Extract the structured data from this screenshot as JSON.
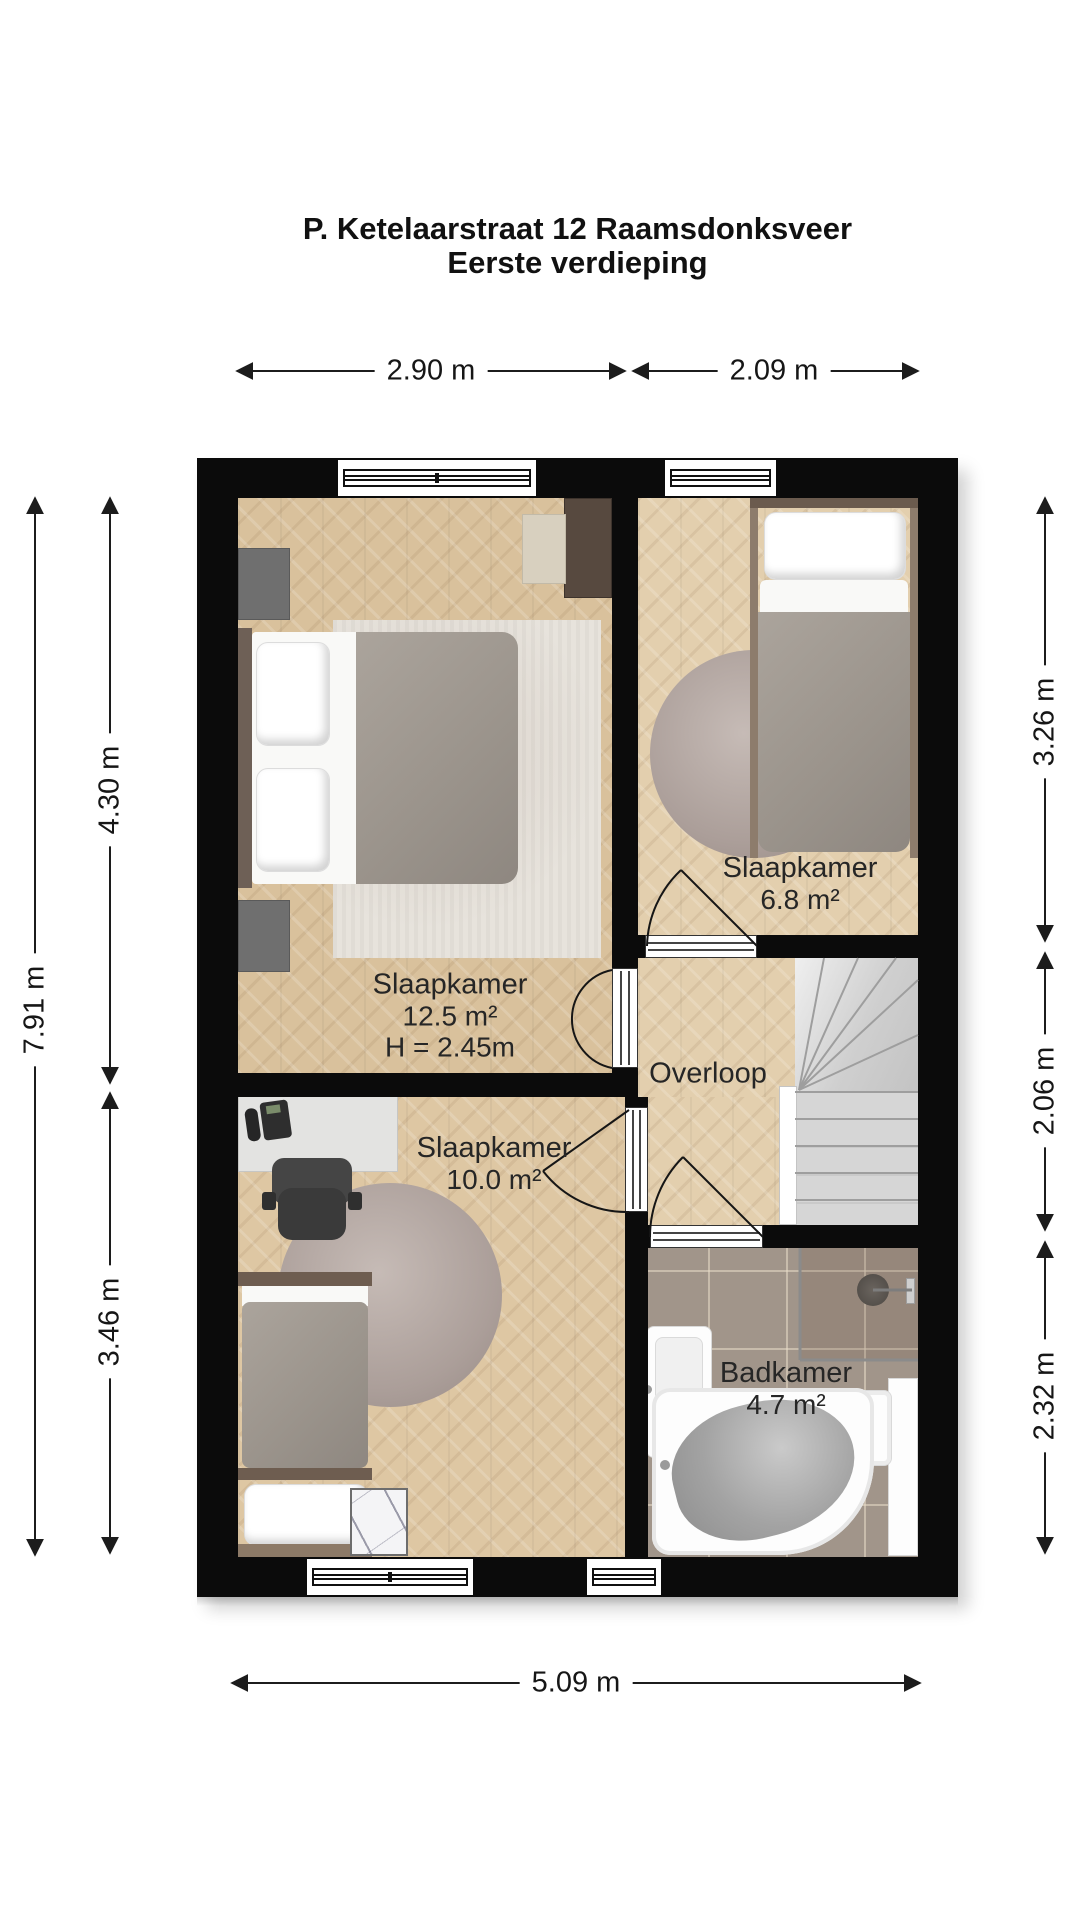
{
  "title": {
    "line1": "P. Ketelaarstraat 12 Raamsdonksveer",
    "line2": "Eerste verdieping"
  },
  "rooms": {
    "bedroom_large": {
      "name": "Slaapkamer",
      "area": "12.5 m²",
      "ceiling": "H = 2.45m"
    },
    "bedroom_right": {
      "name": "Slaapkamer",
      "area": "6.8 m²"
    },
    "bedroom_lower": {
      "name": "Slaapkamer",
      "area": "10.0 m²"
    },
    "landing": {
      "name": "Overloop"
    },
    "bathroom": {
      "name": "Badkamer",
      "area": "4.7 m²"
    }
  },
  "dimensions": {
    "top_left_width": "2.90 m",
    "top_right_width": "2.09 m",
    "left_upper": "4.30 m",
    "left_total": "7.91 m",
    "left_lower": "3.46 m",
    "right_upper": "3.26 m",
    "right_middle": "2.06 m",
    "right_lower": "2.32 m",
    "bottom_total": "5.09 m"
  },
  "colors": {
    "wall": "#0b0b0b",
    "wood_floor": "#d9c19c",
    "tile_floor": "#a1958a",
    "stairs": "#d6d6d6",
    "label_text": "#262626"
  }
}
